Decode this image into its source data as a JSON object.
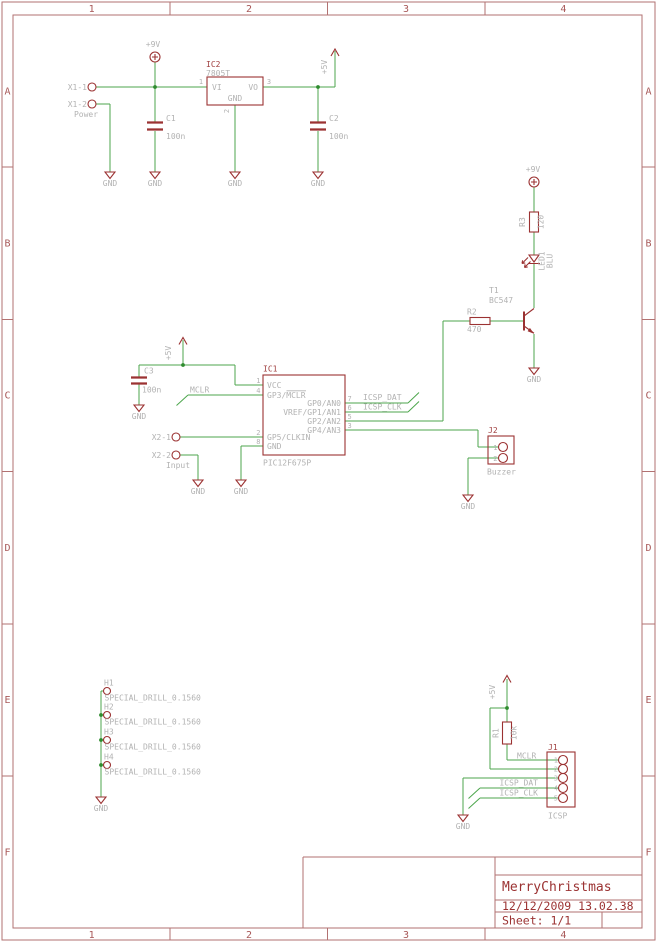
{
  "common": {
    "gnd": "GND",
    "plus_5v": "+5V",
    "plus_9v": "+9V"
  },
  "frame": {
    "columns": [
      "1",
      "2",
      "3",
      "4"
    ],
    "rows": [
      "A",
      "B",
      "C",
      "D",
      "E",
      "F"
    ],
    "title_block": {
      "title": "MerryChristmas",
      "timestamp": "12/12/2009 13.02.38",
      "sheet": "Sheet: 1/1"
    }
  },
  "power": {
    "x1": {
      "pin1": "X1-1",
      "pin2": "X1-2",
      "label": "Power"
    },
    "ic2": {
      "ref": "IC2",
      "value": "7805T",
      "pin_vi": "VI",
      "pin_vo": "VO",
      "pin_gnd": "GND",
      "num_vi": "1",
      "num_vo": "3",
      "num_gnd": "2"
    },
    "c1": {
      "ref": "C1",
      "value": "100n"
    },
    "c2": {
      "ref": "C2",
      "value": "100n"
    }
  },
  "led": {
    "r3": {
      "ref": "R3",
      "value": "120"
    },
    "led1": {
      "ref": "LED1",
      "value": "BLU"
    },
    "t1": {
      "ref": "T1",
      "value": "BC547"
    },
    "r2": {
      "ref": "R2",
      "value": "470"
    }
  },
  "mcu": {
    "ic1": {
      "ref": "IC1",
      "value": "PIC12F675P"
    },
    "c3": {
      "ref": "C3",
      "value": "100n"
    },
    "pins_left": [
      {
        "num": "1",
        "name": "VCC"
      },
      {
        "num": "4",
        "name": "GP3/MCLR"
      },
      {
        "num": "2",
        "name": "GP5/CLKIN"
      },
      {
        "num": "8",
        "name": "GND"
      }
    ],
    "pins_right": [
      {
        "num": "7",
        "name": "GP0/AN0"
      },
      {
        "num": "6",
        "name": "VREF/GP1/AN1"
      },
      {
        "num": "5",
        "name": "GP2/AN2"
      },
      {
        "num": "3",
        "name": "GP4/AN3"
      }
    ],
    "nets": {
      "mclr": "MCLR",
      "icsp_dat": "ICSP_DAT",
      "icsp_clk": "ICSP_CLK"
    },
    "x2": {
      "pin1": "X2-1",
      "pin2": "X2-2",
      "label": "Input"
    },
    "j2": {
      "ref": "J2",
      "label": "Buzzer",
      "num1": "1",
      "num2": "2"
    }
  },
  "holes": {
    "items": [
      {
        "ref": "H1",
        "value": "SPECIAL_DRILL_0.1560"
      },
      {
        "ref": "H2",
        "value": "SPECIAL_DRILL_0.1560"
      },
      {
        "ref": "H3",
        "value": "SPECIAL_DRILL_0.1560"
      },
      {
        "ref": "H4",
        "value": "SPECIAL_DRILL_0.1560"
      }
    ]
  },
  "icsp": {
    "r1": {
      "ref": "R1",
      "value": "10k"
    },
    "nets": {
      "mclr": "MCLR",
      "icsp_dat": "ICSP_DAT",
      "icsp_clk": "ICSP_CLK"
    },
    "j1": {
      "ref": "J1",
      "label": "ICSP",
      "nums": [
        "1",
        "2",
        "3",
        "4",
        "5"
      ]
    }
  },
  "colors": {
    "wire_green": "#4ca64c",
    "junction_green": "#2e8b2e",
    "symbol_red": "#9b3232",
    "frame_red": "#b27272",
    "label_gray": "#b2b2b2",
    "background": "#ffffff"
  }
}
